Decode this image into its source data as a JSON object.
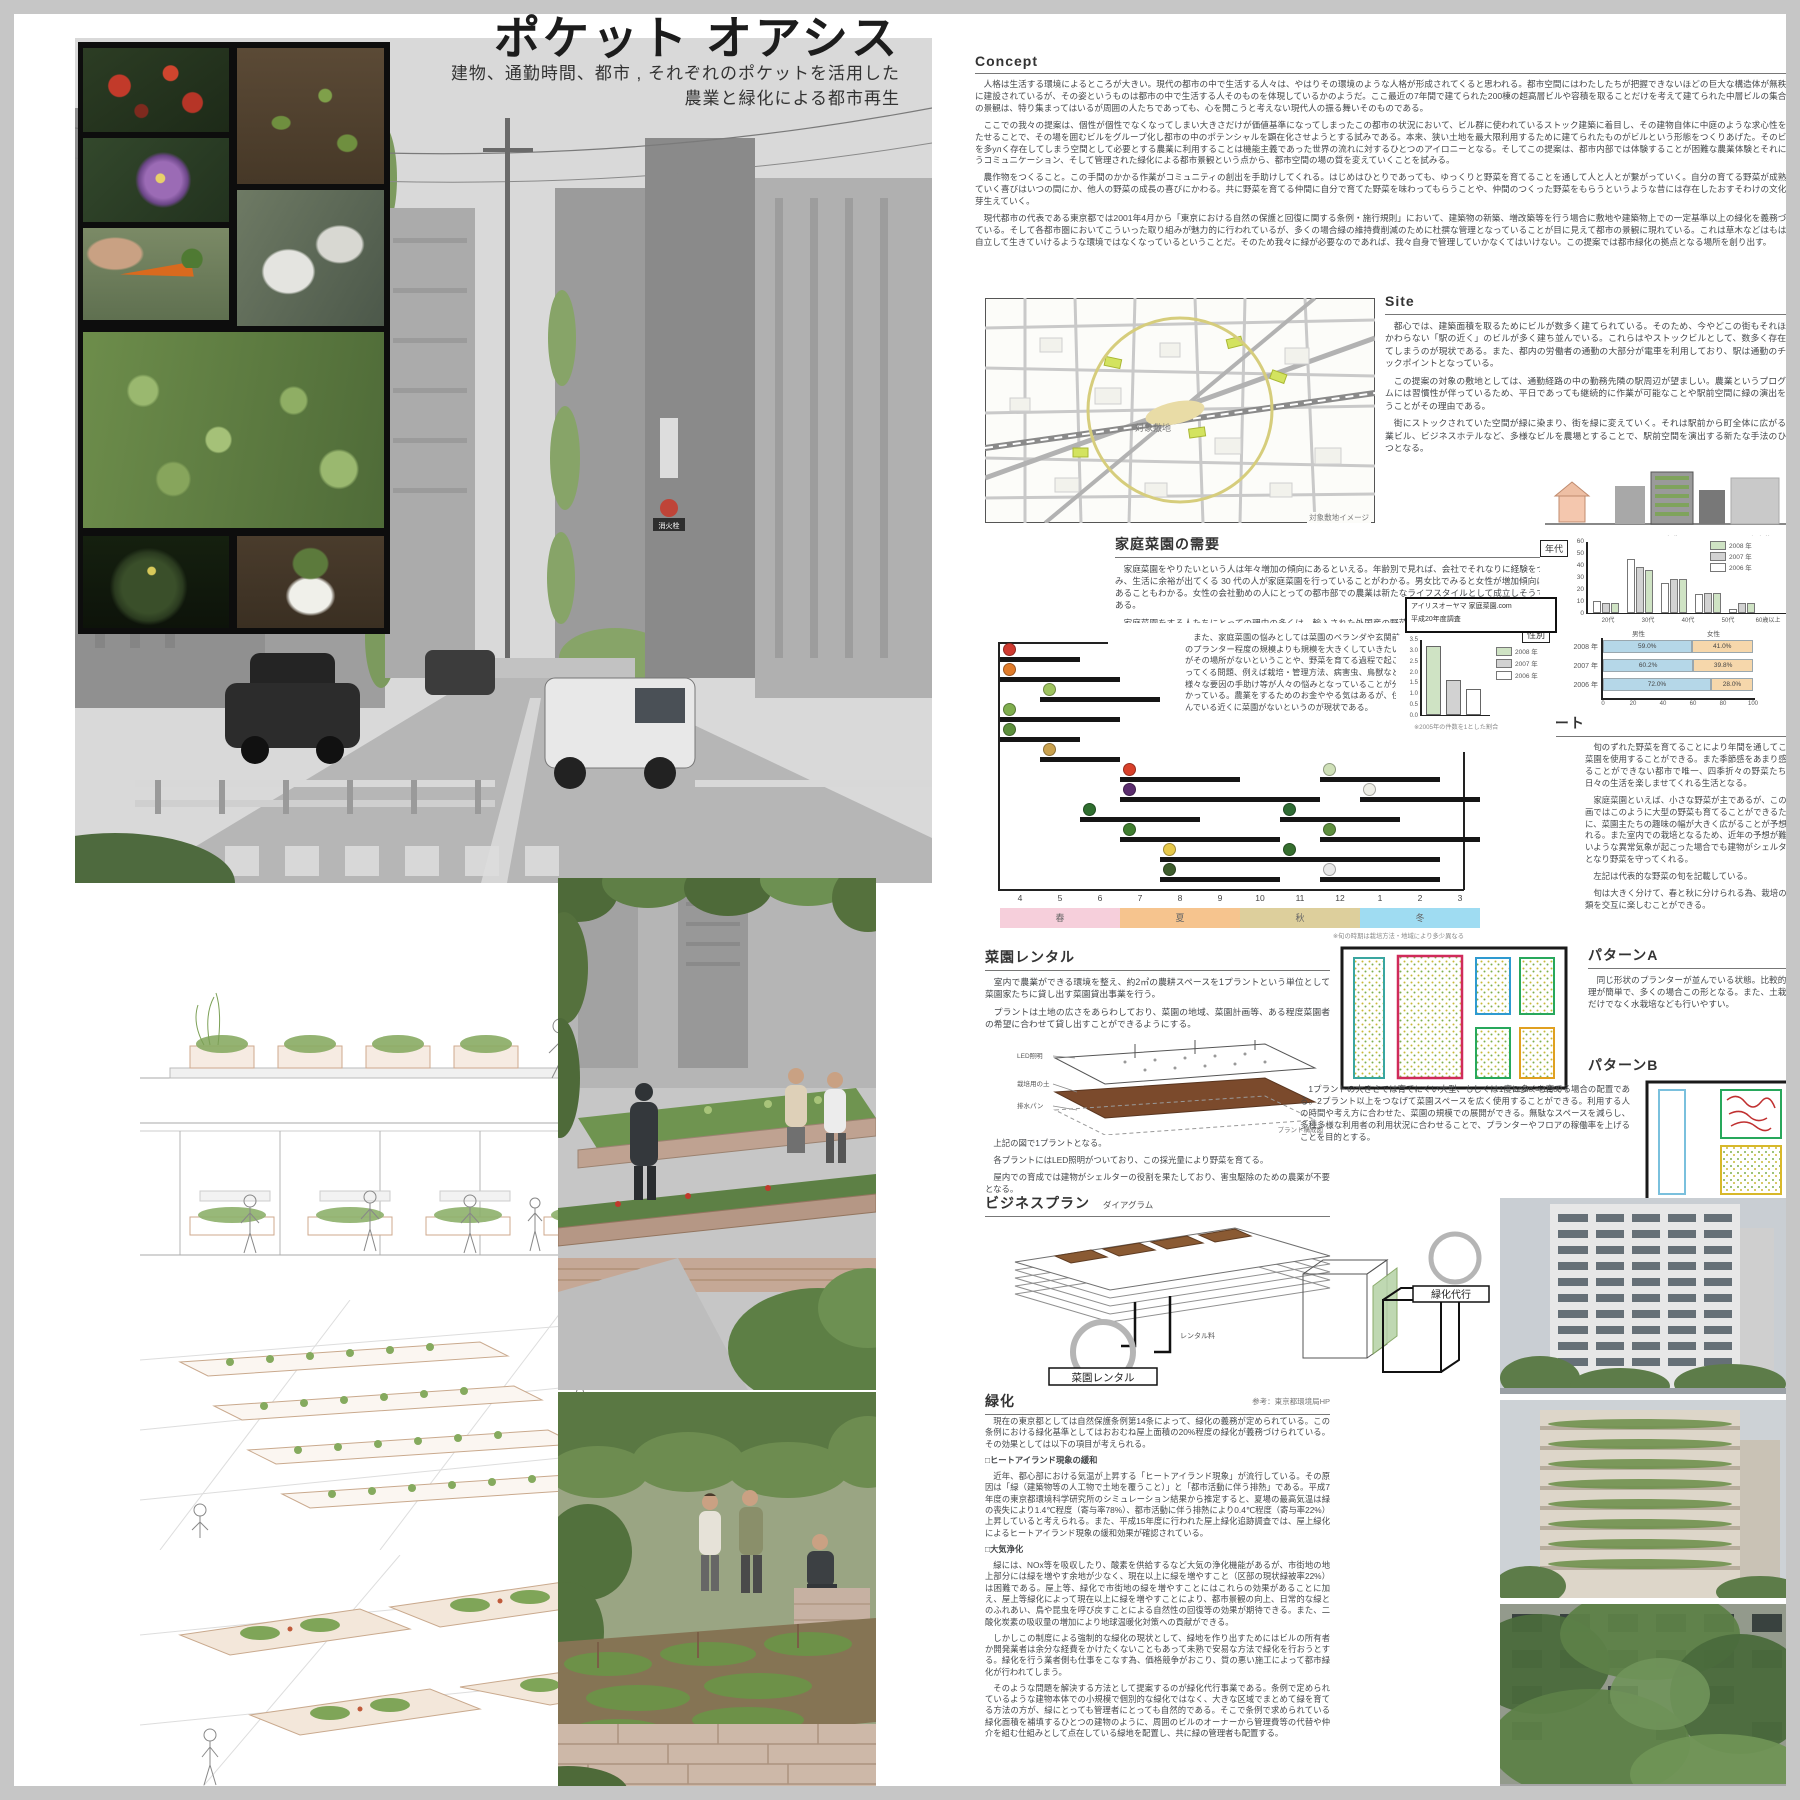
{
  "poster": {
    "title": "ポケット オアシス",
    "subtitle1": "建物、通勤時間、都市 , それぞれのポケットを活用した",
    "subtitle2": "農業と緑化による都市再生"
  },
  "street": {
    "sign1": "消火栓"
  },
  "concept": {
    "heading": "Concept",
    "paragraphs": [
      "人格は生活する環境によるところが大きい。現代の都市の中で生活する人々は、やはりその環境のような人格が形成されてくると思われる。都市空間にはわたしたちが把握できないほどの巨大な構造体が無秩序に建設されているが、その姿というものは都市の中で生活する人そのものを体現しているかのようだ。ここ最近の7年間で建てられた200棟の超高層ビルや容積を取ることだけを考えて建てられた中層ビルの集合体の景観は、特り集まってはいるが周囲の人たちであっても、心を開こうと考えない現代人の振る舞いそのものである。",
      "ここでの我々の提案は、個性が個性でなくなってしまい大きさだけが価値基準になってしまったこの都市の状況において、ビル群に使われているストック建築に着目し、その建物自体に中庭のような求心性を持たせることで、その場を囲むビルをグループ化し都市の中のポテンシャルを顕在化させようとする試みである。本来、狭い土地を最大限利用するために建てられたものがビルという形態をつくりあげた。そのビルを多улく存在してしまう空間として必要とする農業に利用することは機能主義であった世界の流れに対するひとつのアイロニーとなる。そしてこの提案は、都市内部では体験することが困難な農業体験とそれに伴うコミュニケーション、そして管理された緑化による都市景観という点から、都市空間の場の質を変えていくことを試みる。",
      "農作物をつくること。この手間のかかる作業がコミュニティの創出を手助けしてくれる。はじめはひとりであっても、ゆっくりと野菜を育てることを通して人と人とが繋がっていく。自分の育てる野菜が成熟していく喜びはいつの間にか、他人の野菜の成長の喜びにかわる。共に野菜を育てる仲間に自分で育てた野菜を味わってもらうことや、仲間のつくった野菜をもらうというような昔には存在したおすそわけの文化が芽生えていく。",
      "現代都市の代表である東京都では2001年4月から「東京における自然の保護と回復に関する条例・施行規則」において、建築物の新築、増改築等を行う場合に敷地や建築物上での一定基準以上の緑化を義務づけている。そして各都市圏においてこういった取り組みが魅力的に行われているが、多くの場合緑の維持費削減のために杜撰な管理となっていることが目に見えて都市の景観に現れている。これは草木などはもはや自立して生きていけるような環境ではなくなっているということだ。そのため我々に緑が必要なのであれば、我々自身で管理していかなくてはいけない。この提案では都市緑化の拠点となる場所を創り出す。"
    ]
  },
  "site": {
    "heading": "Site",
    "paragraphs": [
      "都心では、建築面積を取るためにビルが数多く建てられている。そのため、今やどこの街もそれほどかわらない「駅の近く」のビルが多く建ち並んでいる。これらはやストックビルとして、数多く存在してしまうのが現状である。また、都内の労働者の通勤の大部分が電車を利用しており、駅は通勤のチェックポイントとなっている。",
      "この提案の対象の敷地としては、通勤経路の中の勤務先隣の駅周辺が望ましい。農業というプログラムには習慣性が伴っているため、平日であっても継続的に作業が可能なことや駅前空間に緑の演出を行うことがその理由である。",
      "街にストックされていた空間が緑に染まり、街を緑に変えていく。それは駅前から町全体に広がる商業ビル、ビジネスホテルなど、多様なビルを農場とすることで、駅前空間を演出する新たな手法のひとつとなる。"
    ],
    "map_label": "対象敷地",
    "map_caption": "対象敷地イメージ",
    "illustration_caption": "出典：アイリスオーヤマ 家庭菜園.com"
  },
  "demand": {
    "heading": "家庭菜園の需要",
    "paragraphs": [
      "家庭菜園をやりたいという人は年々増加の傾向にあるといえる。年齢別で見れば、会社でそれなりに経験をつみ、生活に余裕が出てくる 30 代の人が家庭菜園を行っていることがわかる。男女比でみると女性が増加傾向にあることもわかる。女性の会社勤めの人にとっての都市部での農業は新たなライフスタイルとして成立しそうである。",
      "家庭菜園をする人たちにとっての理由の多くは、輸入された外国産の野菜や農薬で育てられた野菜などよりも自分で育てた安心できる野菜を食べたいということである。",
      "また、家庭菜園の悩みとしては菜園のベランダや玄関前のプランター程度の規模よりも規模を大きくしていきたいがその場所がないということや、野菜を育てる過程で起こってくる問題、例えば栽培・管理方法、病害虫、鳥獣など様々な要因の手助け等が人々の悩みとなっていることが分かっている。農業をするためのお金ややる気はあるが、住んでいる近くに菜園がないというのが現状である。"
    ],
    "source_box_line1": "アイリスオーヤマ 家庭菜園.com",
    "source_box_line2": "平成20年度調査"
  },
  "harvest": {
    "heading": "収穫チャート",
    "paragraphs": [
      "旬のずれた野菜を育てることにより年間を通してこの菜園を使用することができる。また季節感をあまり感じることができない都市で唯一、四季折々の野菜たちが日々の生活を楽しませてくれる生活となる。",
      "家庭菜園といえば、小さな野菜が主であるが、この計画ではこのように大型の野菜も育てることができるために、菜園主たちの趣味の幅が大きく広がることが予想される。また室内での栽培となるため、近年の予想が難しいような異常気象が起こった場合でも建物がシェルターとなり野菜を守ってくれる。",
      "左記は代表的な野菜の旬を記載している。",
      "旬は大きく分けて、春と秋に分けられる為、栽培の種類を交互に楽しむことができる。"
    ],
    "note": "※旬の時期は栽培方法・地域により多少異なる"
  },
  "rental": {
    "heading": "菜園レンタル",
    "paragraphs": [
      "室内で農業ができる環境を整え、約2㎡の農耕スペースを1プラントという単位として菜園家たちに貸し出す菜園貸出事業を行う。",
      "プラントは土地の広さをあらわしており、菜園の地域、菜園計画等、ある程度菜園者の希望に合わせて貸し出すことができるようにする。"
    ],
    "diagram_labels": [
      "LED照明",
      "栽培用の土",
      "排水パン"
    ],
    "diagram_caption": "プラント構成図",
    "paragraphs2": [
      "上記の図で1プラントとなる。",
      "各プラントにはLED照明がついており、この採光量により野菜を育てる。",
      "屋内での育成では建物がシェルターの役割を果たしており、害虫駆除のための農薬が不要となる。"
    ]
  },
  "patternA": {
    "heading": "パターンA",
    "text": "同じ形状のプランターが並んでいる状態。比較的管理が簡単で、多くの場合この形となる。また、土栽培だけでなく水栽培なども行いやすい。",
    "scale": "Scale = 1/200"
  },
  "patternB": {
    "heading": "パターンB",
    "text": "1プラントの大きさでは育てにくい大型、もしくは1度に多くを育てる場合の配置である。2プラント以上をつなげて菜園スペースを広く使用することができる。利用する人の時間や考え方に合わせた、菜園の規模での展開ができる。無駄なスペースを減らし、多種多様な利用者の利用状況に合わせることで、プランターやフロアの稼働率を上げることを目的とする。",
    "scale": "Scale = 1/200"
  },
  "business": {
    "heading": "ビジネスプラン",
    "sub": "ダイアグラム",
    "label_rental": "菜園レンタル",
    "label_green": "緑化代行",
    "label_fee": "レンタル料"
  },
  "greening": {
    "heading": "緑化",
    "ref": "参考：東京都環境局HP",
    "paragraphs": [
      "現在の東京都としては自然保護条例第14条によって、緑化の義務が定められている。この条例における緑化基準としてはおおむね屋上面積の20%程度の緑化が義務づけられている。その効果としては以下の項目が考えられる。",
      "□ヒートアイランド現象の緩和",
      "近年、都心部における気温が上昇する「ヒートアイランド現象」が流行している。その原因は「緑（建築物等の人工物で土地を覆うこと）」と「都市活動に伴う排熱」である。平成7年度の東京都環境科学研究所のシミュレーション結果から推定すると、夏場の最高気温は緑の喪失により1.4℃程度（寄与率78%）、都市活動に伴う排熱により0.4℃程度（寄与率22%）上昇していると考えられる。また、平成15年度に行われた屋上緑化追跡調査では、屋上緑化によるヒートアイランド現象の緩和効果が確認されている。",
      "□大気浄化",
      "緑には、NOx等を吸収したり、酸素を供給するなど大気の浄化機能があるが、市街地の地上部分には緑を増やす余地が少なく、現在以上に緑を増やすこと（区部の現状緑被率22%）は困難である。屋上等、緑化で市街地の緑を増やすことにはこれらの効果があることに加え、屋上等緑化によって現在以上に緑を増やすことにより、都市景観の向上、日常的な緑とのふれあい、鳥や昆虫を呼び戻すことによる自然性の回復等の効果が期待できる。また、二酸化炭素の吸収量の増加により地球温暖化対策への貢献ができる。",
      "しかしこの制度による強制的な緑化の現状として、緑地を作り出すためにはビルの所有者か開発業者は余分な経費をかけたくないこともあって未熟で安易な方法で緑化を行おうとする。緑化を行う業者側も仕事をこなす為、価格競争がおこり、質の悪い施工によって都市緑化が行われてしまう。",
      "そのような問題を解決する方法として提案するのが緑化代行事業である。条例で定められているような建物本体での小規模で個別的な緑化ではなく、大きな区域でまとめて緑を育てる方法の方が、緑にとっても管理者にとっても自然的である。そこで条例で求められている緑化面積を補填するひとつの建物のように、周囲のビルのオーナーから管理費等の代替や仲介を組む仕組みとして点在している緑地を配置し、共に緑の管理者も配置する。"
    ]
  },
  "chart_data": [
    {
      "id": "age",
      "type": "bar",
      "label": "年代",
      "categories": [
        "20代",
        "30代",
        "40代",
        "50代",
        "60歳以上"
      ],
      "series": [
        {
          "name": "2008 年",
          "color": "#cfe3c4",
          "values": [
            8,
            36,
            28,
            17,
            8
          ]
        },
        {
          "name": "2007 年",
          "color": "#d2d2d2",
          "values": [
            8,
            38,
            28,
            17,
            8
          ]
        },
        {
          "name": "2006 年",
          "color": "#ffffff",
          "values": [
            10,
            45,
            25,
            16,
            3
          ]
        }
      ],
      "ylim": [
        0,
        60
      ],
      "yticks": [
        0,
        10,
        20,
        30,
        40,
        50,
        60
      ]
    },
    {
      "id": "growth",
      "type": "bar",
      "categories": [
        "2008 年",
        "2007 年",
        "2006 年"
      ],
      "values": [
        3.2,
        1.6,
        1.2
      ],
      "colors": [
        "#cfe3c4",
        "#d2d2d2",
        "#ffffff"
      ],
      "ylim": [
        0,
        3.5
      ],
      "yticks": [
        0,
        0.5,
        1,
        1.5,
        2,
        2.5,
        3,
        3.5
      ],
      "caption": "※2005年の件数を1とした割合"
    },
    {
      "id": "gender",
      "type": "stacked-bar-horizontal",
      "label": "性別",
      "columns": [
        "男性",
        "女性"
      ],
      "colors": [
        "#b5d7e8",
        "#f6d7ab"
      ],
      "rows": [
        {
          "label": "2008 年",
          "values": [
            59.0,
            41.0
          ],
          "texts": [
            "59.0%",
            "41.0%"
          ]
        },
        {
          "label": "2007 年",
          "values": [
            60.2,
            39.8
          ],
          "texts": [
            "60.2%",
            "39.8%"
          ]
        },
        {
          "label": "2006 年",
          "values": [
            72.0,
            28.0
          ],
          "texts": [
            "72.0%",
            "28.0%"
          ]
        }
      ],
      "xticks": [
        0,
        20,
        40,
        60,
        80,
        100
      ]
    },
    {
      "id": "harvest_calendar",
      "type": "gantt",
      "months": [
        "4",
        "5",
        "6",
        "7",
        "8",
        "9",
        "10",
        "11",
        "12",
        "1",
        "2",
        "3"
      ],
      "seasons": [
        {
          "name": "春",
          "color": "#f6cfdb"
        },
        {
          "name": "夏",
          "color": "#f6c48e"
        },
        {
          "name": "秋",
          "color": "#ddcf9c"
        },
        {
          "name": "冬",
          "color": "#9fdcf2"
        }
      ],
      "items": [
        {
          "name": "イチゴ",
          "color": "#cf3a30",
          "row": 0,
          "start": 0,
          "end": 1
        },
        {
          "name": "ニンジン",
          "color": "#e07b2a",
          "row": 1,
          "start": 0,
          "end": 2
        },
        {
          "name": "レタス",
          "color": "#9ec35f",
          "row": 2,
          "start": 1,
          "end": 3
        },
        {
          "name": "キャベツ",
          "color": "#7fae4e",
          "row": 3,
          "start": 0,
          "end": 2
        },
        {
          "name": "エンドウ",
          "color": "#5c8f3c",
          "row": 4,
          "start": 0,
          "end": 1
        },
        {
          "name": "タマネギ",
          "color": "#c9a14e",
          "row": 5,
          "start": 1,
          "end": 2
        },
        {
          "name": "トマト",
          "color": "#d8402a",
          "row": 6,
          "start": 3,
          "end": 5
        },
        {
          "name": "ハクサイ",
          "color": "#cfe0b8",
          "row": 6,
          "start": 8,
          "end": 10
        },
        {
          "name": "ナス",
          "color": "#5b2d6e",
          "row": 7,
          "start": 3,
          "end": 7
        },
        {
          "name": "ダイコン",
          "color": "#eeeee6",
          "row": 7,
          "start": 9,
          "end": 11
        },
        {
          "name": "キュウリ",
          "color": "#2f6e2f",
          "row": 8,
          "start": 2,
          "end": 4
        },
        {
          "name": "ブロッコリー",
          "color": "#2e6b33",
          "row": 8,
          "start": 7,
          "end": 9
        },
        {
          "name": "ピーマン",
          "color": "#3f7d2f",
          "row": 9,
          "start": 3,
          "end": 6
        },
        {
          "name": "ネギ",
          "color": "#5e8f3e",
          "row": 9,
          "start": 8,
          "end": 11
        },
        {
          "name": "トウモロコシ",
          "color": "#e6c84a",
          "row": 10,
          "start": 4,
          "end": 6
        },
        {
          "name": "ホウレンソウ",
          "color": "#356e2e",
          "row": 10,
          "start": 7,
          "end": 10
        },
        {
          "name": "カボチャ",
          "color": "#3d5c2c",
          "row": 11,
          "start": 4,
          "end": 6
        },
        {
          "name": "カブ",
          "color": "#e8e8e8",
          "row": 11,
          "start": 8,
          "end": 10
        }
      ]
    }
  ]
}
